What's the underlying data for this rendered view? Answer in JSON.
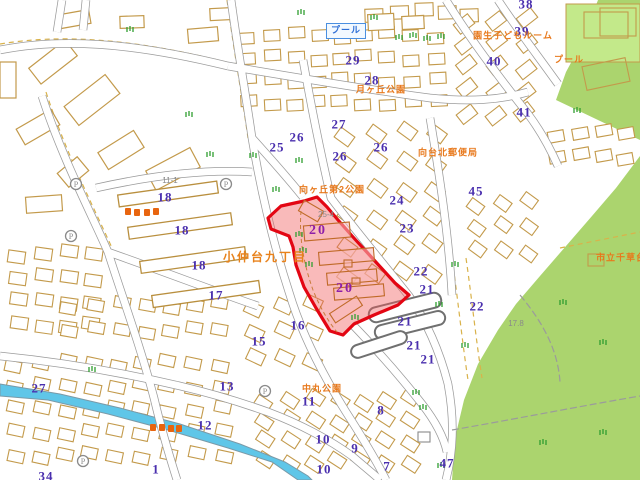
{
  "map": {
    "colors": {
      "background": "#ffffff",
      "park_green": "#abd46e",
      "pool_parcel_green": "#c3e98a",
      "river_blue": "#5fc6e8",
      "building_outline_tan": "#c39a4b",
      "road_casing_gray": "#9b9b9b",
      "block_number_purple": "#4a2fae",
      "highlight_number_magenta": "#8e1fa8",
      "place_name_orange": "#e8791c",
      "highlight_red": "#e30613",
      "highlight_fill_pink": "rgba(240,90,90,0.42)",
      "pool_label_blue": "#2e6fd6",
      "vegetation_green": "#2f9e2f"
    },
    "labels": {
      "block_numbers": [
        {
          "t": "38",
          "x": 526,
          "y": 4
        },
        {
          "t": "29",
          "x": 353,
          "y": 60
        },
        {
          "t": "28",
          "x": 372,
          "y": 80
        },
        {
          "t": "39",
          "x": 522,
          "y": 31
        },
        {
          "t": "40",
          "x": 494,
          "y": 61
        },
        {
          "t": "41",
          "x": 524,
          "y": 112
        },
        {
          "t": "25",
          "x": 277,
          "y": 147
        },
        {
          "t": "26",
          "x": 297,
          "y": 137
        },
        {
          "t": "27",
          "x": 339,
          "y": 124
        },
        {
          "t": "26",
          "x": 340,
          "y": 156
        },
        {
          "t": "26",
          "x": 381,
          "y": 147
        },
        {
          "t": "24",
          "x": 397,
          "y": 200
        },
        {
          "t": "23",
          "x": 407,
          "y": 228
        },
        {
          "t": "45",
          "x": 476,
          "y": 191
        },
        {
          "t": "22",
          "x": 421,
          "y": 271
        },
        {
          "t": "21",
          "x": 427,
          "y": 289
        },
        {
          "t": "22",
          "x": 477,
          "y": 306
        },
        {
          "t": "21",
          "x": 405,
          "y": 321
        },
        {
          "t": "21",
          "x": 414,
          "y": 345
        },
        {
          "t": "21",
          "x": 428,
          "y": 359
        },
        {
          "t": "18",
          "x": 165,
          "y": 197
        },
        {
          "t": "18",
          "x": 182,
          "y": 230
        },
        {
          "t": "18",
          "x": 199,
          "y": 265
        },
        {
          "t": "17",
          "x": 216,
          "y": 295
        },
        {
          "t": "16",
          "x": 298,
          "y": 325
        },
        {
          "t": "15",
          "x": 259,
          "y": 341
        },
        {
          "t": "27",
          "x": 39,
          "y": 388
        },
        {
          "t": "13",
          "x": 227,
          "y": 386
        },
        {
          "t": "12",
          "x": 205,
          "y": 425
        },
        {
          "t": "34",
          "x": 46,
          "y": 476
        },
        {
          "t": "1",
          "x": 156,
          "y": 469
        },
        {
          "t": "11",
          "x": 309,
          "y": 401
        },
        {
          "t": "8",
          "x": 381,
          "y": 410
        },
        {
          "t": "10",
          "x": 323,
          "y": 439
        },
        {
          "t": "9",
          "x": 355,
          "y": 448
        },
        {
          "t": "10",
          "x": 324,
          "y": 469
        },
        {
          "t": "7",
          "x": 387,
          "y": 466
        },
        {
          "t": "47",
          "x": 447,
          "y": 463
        }
      ],
      "highlight_numbers": [
        {
          "t": "20",
          "x": 318,
          "y": 231
        },
        {
          "t": "20",
          "x": 345,
          "y": 289
        }
      ],
      "place_names": [
        {
          "t": "プール",
          "x": 346,
          "y": 31,
          "style": "pool"
        },
        {
          "t": "月ヶ丘公園",
          "x": 381,
          "y": 90
        },
        {
          "t": "園生子どもルーム",
          "x": 513,
          "y": 36
        },
        {
          "t": "プール",
          "x": 569,
          "y": 60
        },
        {
          "t": "向ヶ丘第2公園",
          "x": 332,
          "y": 190
        },
        {
          "t": "向台北郵便局",
          "x": 448,
          "y": 153
        },
        {
          "t": "小仲台九丁目",
          "x": 265,
          "y": 257,
          "style": "district"
        },
        {
          "t": "中丸公園",
          "x": 322,
          "y": 389
        },
        {
          "t": "市立千草台",
          "x": 596,
          "y": 258,
          "align": "left"
        }
      ],
      "parcel_numbers": [
        {
          "t": "11-1",
          "x": 170,
          "y": 181
        },
        {
          "t": "25-4",
          "x": 326,
          "y": 215
        },
        {
          "t": "17.8",
          "x": 516,
          "y": 324
        }
      ],
      "parking_letter": "P"
    },
    "icons": {
      "parking": [
        [
          76,
          184
        ],
        [
          71,
          236
        ],
        [
          226,
          184
        ],
        [
          265,
          391
        ],
        [
          83,
          461
        ]
      ],
      "shops": [
        [
          128,
          212
        ],
        [
          137,
          213
        ],
        [
          147,
          213
        ],
        [
          156,
          212
        ],
        [
          153,
          428
        ],
        [
          162,
          428
        ],
        [
          171,
          429
        ],
        [
          179,
          429
        ]
      ],
      "vegetation": [
        [
          298,
          10
        ],
        [
          371,
          15
        ],
        [
          396,
          35
        ],
        [
          410,
          33
        ],
        [
          424,
          36
        ],
        [
          438,
          34
        ],
        [
          250,
          153
        ],
        [
          296,
          158
        ],
        [
          273,
          187
        ],
        [
          207,
          152
        ],
        [
          186,
          112
        ],
        [
          127,
          27
        ],
        [
          89,
          367
        ],
        [
          452,
          262
        ],
        [
          462,
          343
        ],
        [
          436,
          302
        ],
        [
          413,
          390
        ],
        [
          420,
          405
        ],
        [
          438,
          463
        ],
        [
          296,
          232
        ],
        [
          300,
          248
        ],
        [
          306,
          262
        ],
        [
          352,
          315
        ],
        [
          560,
          300
        ],
        [
          600,
          340
        ],
        [
          540,
          440
        ],
        [
          600,
          430
        ],
        [
          574,
          108
        ]
      ]
    },
    "geometry": {
      "parks": [
        "598,0 640,0 640,140 556,100 566,72 580,46",
        "640,156 616,188 592,216 566,246 540,276 516,304 498,330 478,364 464,400 455,438 452,480 640,480"
      ],
      "pool_parcel": [
        566,
        4,
        74,
        58
      ],
      "river": "0,384 60,394 120,408 180,424 240,444 285,462 308,476 312,480 298,480 272,462 228,448 168,430 108,414 48,400 0,396",
      "roads": [
        "M0,50 C60,38 130,42 228,66",
        "M42,96 C62,158 92,215 108,252 C122,296 140,345 154,398 C162,432 170,458 177,480",
        "M231,0 C239,58 247,102 252,138 C261,192 273,243 289,292 C301,332 321,372 346,412 C362,437 376,460 386,480",
        "M303,60 C314,122 324,168 331,198 C356,231 386,267 409,296 C426,320 440,352 448,384 C455,422 453,452 446,480",
        "M430,118 C440,178 449,238 452,295",
        "M228,66 C300,78 370,90 430,98 C470,102 500,100 528,92",
        "M446,0 C468,36 498,76 528,114 C540,130 550,148 558,166",
        "M498,0 C515,26 538,56 558,84",
        "M108,252 C165,272 225,295 258,306",
        "M96,188 C150,176 205,169 252,172",
        "M0,356 C60,362 120,372 180,386 C210,393 240,402 268,412 C300,424 330,440 352,456 C366,468 376,476 380,480",
        "M352,324 C375,348 400,376 422,404 C436,422 444,438 447,452",
        "M252,138 C270,158 288,178 303,197",
        "M62,0 L57,32",
        "M86,0 L83,30"
      ],
      "dashed_tan_paths": [
        "M0,44 C60,34 130,38 226,62",
        "M46,92 C66,154 96,212 112,248",
        "M227,0 C235,58 243,102 248,138",
        "M452,258 C458,300 462,340 468,380",
        "M466,258 C472,300 476,340 482,378",
        "M560,248 C590,242 620,236 640,232"
      ],
      "gray_paths": [
        "M452,430 C510,420 570,408 640,396",
        "M520,295 C545,325 558,352 560,382"
      ],
      "major_buildings": [
        [
          30,
          52,
          46,
          20,
          -38
        ],
        [
          66,
          88,
          52,
          24,
          -38
        ],
        [
          18,
          118,
          40,
          18,
          -30
        ],
        [
          100,
          140,
          42,
          20,
          -32
        ],
        [
          148,
          158,
          50,
          22,
          -28
        ],
        [
          26,
          196,
          36,
          16,
          -4
        ],
        [
          60,
          163,
          26,
          18,
          -40
        ],
        [
          188,
          28,
          30,
          14,
          -5
        ],
        [
          210,
          8,
          26,
          12,
          -3
        ],
        [
          120,
          16,
          24,
          12,
          -2
        ],
        [
          60,
          12,
          30,
          14,
          -10
        ],
        [
          0,
          62,
          16,
          36,
          0
        ],
        [
          368,
          14,
          26,
          16,
          -3
        ],
        [
          402,
          16,
          22,
          13,
          -3
        ]
      ],
      "apartment_slabs": [
        [
          118,
          188,
          100,
          12,
          -8
        ],
        [
          128,
          220,
          104,
          12,
          -8
        ],
        [
          140,
          254,
          106,
          12,
          -8
        ],
        [
          152,
          288,
          108,
          12,
          -8
        ]
      ],
      "oval_buildings": [
        [
          368,
          300,
          74,
          15,
          -14
        ],
        [
          374,
          318,
          72,
          14,
          -14
        ],
        [
          350,
          338,
          58,
          13,
          -18
        ]
      ],
      "park_buildings": [
        [
          600,
          8,
          36,
          28,
          0
        ],
        [
          584,
          62,
          44,
          24,
          -12
        ],
        [
          588,
          254,
          16,
          12,
          0
        ],
        [
          584,
          12,
          44,
          26,
          0
        ],
        [
          418,
          432,
          12,
          10,
          0
        ]
      ],
      "house_regions": [
        [
          238,
          30,
          215,
          90,
          9,
          4,
          16,
          11,
          -3
        ],
        [
          365,
          6,
          118,
          20,
          5,
          1,
          18,
          13,
          -2
        ],
        [
          455,
          15,
          90,
          115,
          3,
          5,
          18,
          12,
          -38
        ],
        [
          336,
          128,
          120,
          168,
          4,
          6,
          17,
          12,
          36
        ],
        [
          8,
          248,
          100,
          95,
          4,
          4,
          17,
          12,
          8
        ],
        [
          5,
          358,
          235,
          115,
          9,
          5,
          16,
          11,
          12
        ],
        [
          255,
          395,
          175,
          82,
          7,
          4,
          16,
          11,
          33
        ],
        [
          548,
          128,
          90,
          46,
          4,
          2,
          16,
          11,
          -10
        ],
        [
          468,
          198,
          76,
          72,
          3,
          3,
          15,
          11,
          36
        ],
        [
          60,
          300,
          180,
          50,
          7,
          2,
          16,
          11,
          10
        ],
        [
          245,
          300,
          85,
          80,
          3,
          3,
          17,
          12,
          25
        ]
      ],
      "highlight": {
        "outline": "304,201 317,197 327,207 338,220 353,237 374,260 395,283 409,295 398,305 374,315 354,324 343,335 330,331 316,308 304,287 296,265 293,247 289,236 271,229 268,218 281,206",
        "buildings": [
          [
            300,
            205,
            22,
            12,
            30
          ],
          [
            304,
            224,
            46,
            15,
            -5
          ],
          [
            319,
            250,
            55,
            13,
            -5
          ],
          [
            327,
            271,
            50,
            12,
            -5
          ],
          [
            334,
            286,
            50,
            12,
            -5
          ],
          [
            344,
            260,
            8,
            7,
            0
          ],
          [
            352,
            278,
            8,
            6,
            0
          ],
          [
            330,
            304,
            32,
            11,
            -33
          ]
        ],
        "inner_path": "M301,211 C299,236 303,262 313,290 C319,305 327,320 337,332"
      },
      "pool_box": [
        328,
        20,
        36,
        20
      ]
    }
  }
}
